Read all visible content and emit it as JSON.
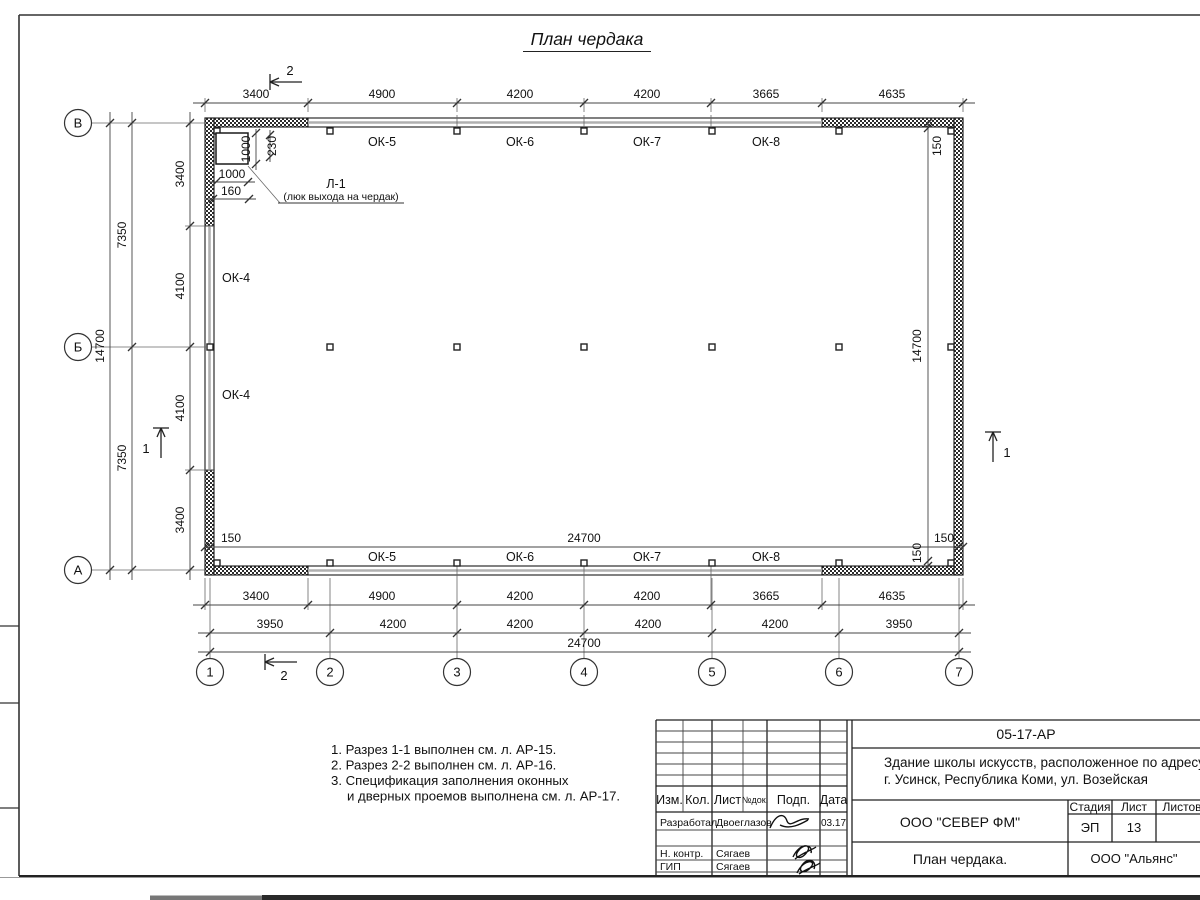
{
  "page": {
    "title": "План чердака"
  },
  "plan": {
    "axes_cols": [
      "1",
      "2",
      "3",
      "4",
      "5",
      "6",
      "7"
    ],
    "axes_rows": [
      "В",
      "Б",
      "А"
    ],
    "dims_top": [
      "3400",
      "4900",
      "4200",
      "4200",
      "3665",
      "4635"
    ],
    "dims_bot1": [
      "3400",
      "4900",
      "4200",
      "4200",
      "3665",
      "4635"
    ],
    "dims_bot2": [
      "3950",
      "4200",
      "4200",
      "4200",
      "4200",
      "3950"
    ],
    "dims_bot_total": "24700",
    "dims_left": [
      "3400",
      "4100",
      "4100",
      "3400"
    ],
    "dims_left_mid": [
      "7350",
      "7350"
    ],
    "dims_left_total": "14700",
    "inner_h": {
      "left": "150",
      "total": "24700",
      "right": "150"
    },
    "inner_v": {
      "top": "150",
      "total": "14700",
      "bottom": "150"
    },
    "win_top": [
      "ОК-5",
      "ОК-6",
      "ОК-7",
      "ОК-8"
    ],
    "win_bot": [
      "ОК-5",
      "ОК-6",
      "ОК-7",
      "ОК-8"
    ],
    "win_left": [
      "ОК-4",
      "ОК-4"
    ],
    "hatch": {
      "label": "Л-1",
      "sub": "(люк выхода на чердак)",
      "d_h": "1000",
      "d_off": "230",
      "d_w": "1000",
      "d_side": "160"
    },
    "sec1": "1",
    "sec2": "2"
  },
  "notes": {
    "n1": "1. Разрез 1-1 выполнен см. л. АР-15.",
    "n2": "2. Разрез 2-2 выполнен см. л. АР-16.",
    "n3": "3. Спецификация заполнения оконных",
    "n4": "и дверных проемов выполнена см. л. АР-17."
  },
  "titleblock": {
    "doc_code": "05-17-АР",
    "project1": "Здание школы искусств, расположенное по адресу:",
    "project2": "г. Усинск, Республика Коми, ул. Возейская",
    "cols": {
      "izm": "Изм.",
      "kol": "Кол.",
      "list": "Лист",
      "ndoc": "№док.",
      "podp": "Подп.",
      "data": "Дата"
    },
    "stage_h": "Стадия",
    "sheet_h": "Лист",
    "sheets_h": "Листов",
    "stage": "ЭП",
    "sheet_no": "13",
    "org": "ООО \"СЕВЕР ФМ\"",
    "drawing_name": "План чердака.",
    "contractor": "ООО \"Альянс\"",
    "rows": [
      {
        "role": "Разработал",
        "name": "Двоеглазов",
        "date": "03.17"
      },
      {
        "role": "Н. контр.",
        "name": "Сягаев"
      },
      {
        "role": "ГИП",
        "name": "Сягаев"
      }
    ]
  }
}
